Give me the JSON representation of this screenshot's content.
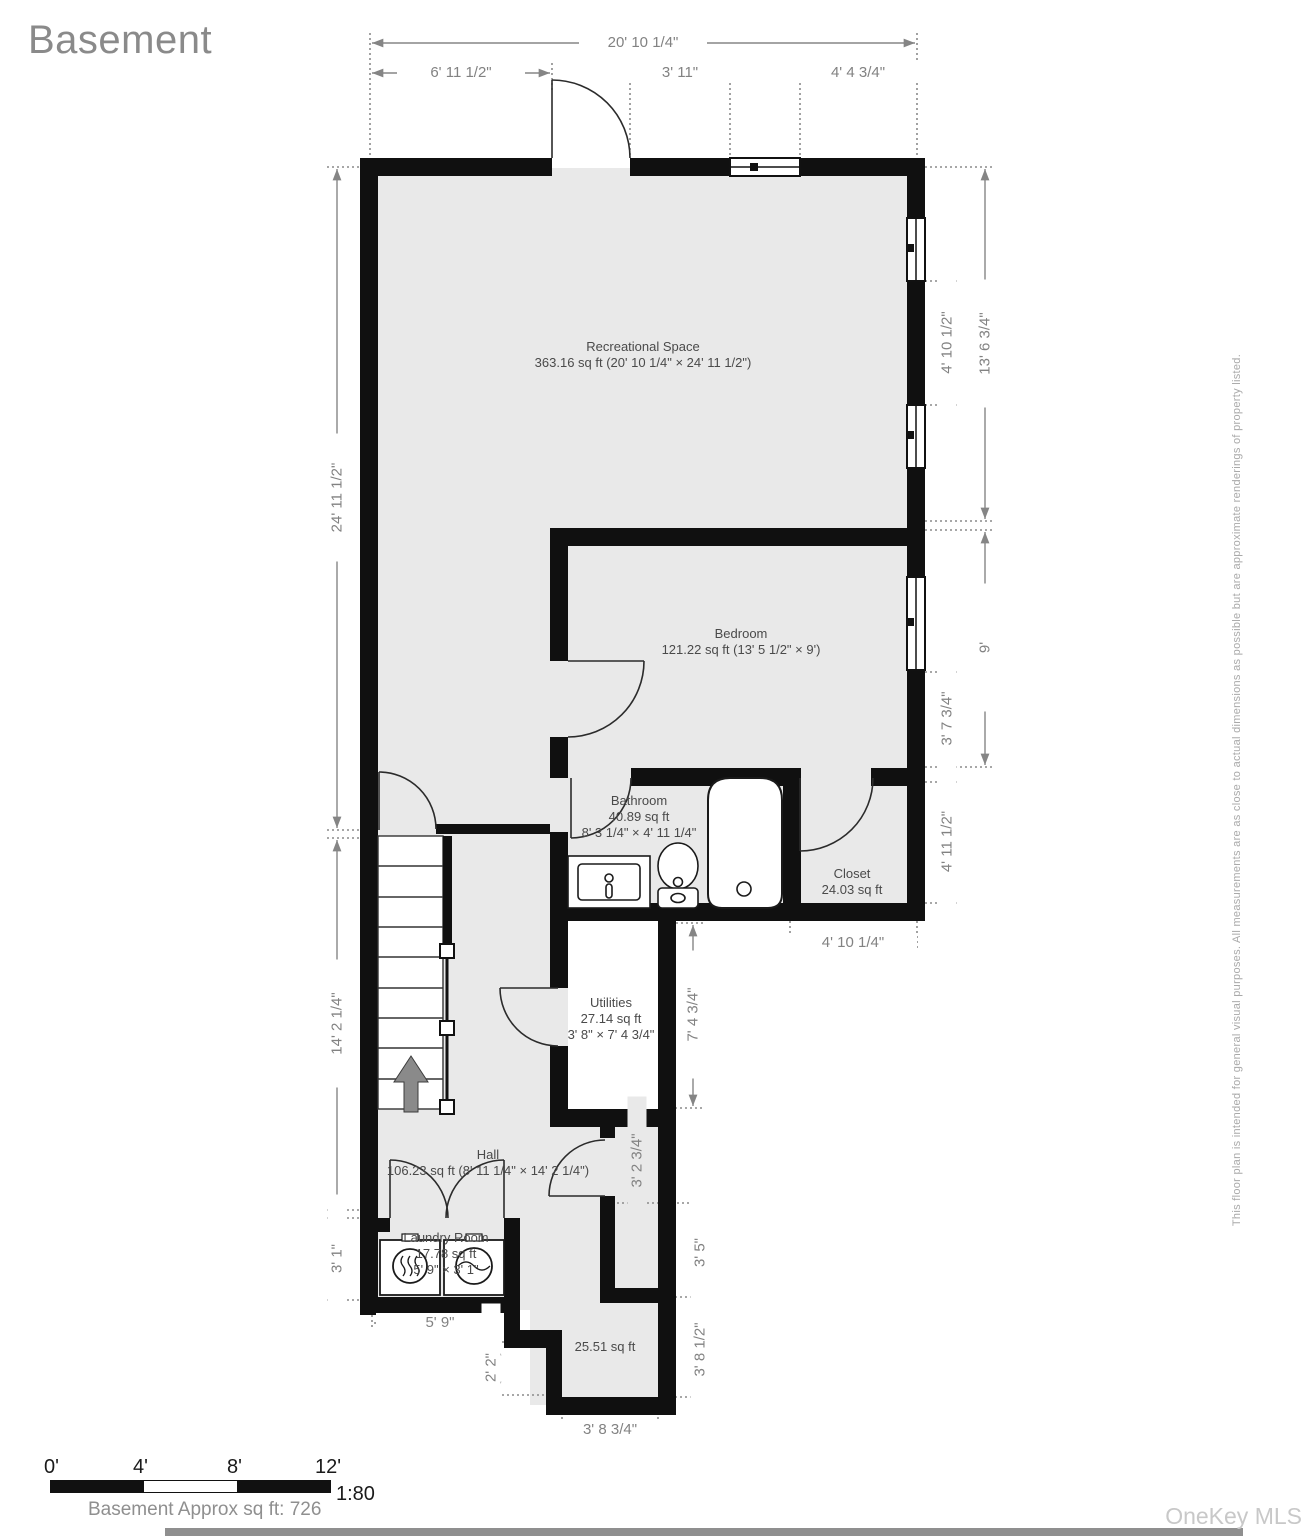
{
  "title": "Basement",
  "rooms": {
    "recreational": {
      "name": "Recreational Space",
      "line2": "363.16 sq ft (20' 10 1/4\" × 24' 11 1/2\")"
    },
    "bedroom": {
      "name": "Bedroom",
      "line2": "121.22 sq ft (13' 5 1/2\" × 9')"
    },
    "bathroom": {
      "name": "Bathroom",
      "line2": "40.89 sq ft",
      "line3": "8' 3 1/4\" × 4' 11 1/4\""
    },
    "closet": {
      "name": "Closet",
      "line2": "24.03 sq ft"
    },
    "utilities": {
      "name": "Utilities",
      "line2": "27.14 sq ft",
      "line3": "3' 8\" × 7' 4 3/4\""
    },
    "hall": {
      "name": "Hall",
      "line2": "106.23 sq ft (8' 11 1/4\" × 14' 2 1/4\")"
    },
    "laundry": {
      "name": "Laundry Room",
      "line2": "17.78 sq ft",
      "line3": "5' 9\" × 3' 1\""
    },
    "nook": {
      "line1": "25.51 sq ft"
    }
  },
  "dimensions": {
    "top_total": "20' 10 1/4\"",
    "top_left": "6' 11 1/2\"",
    "top_mid": "3' 11\"",
    "top_right": "4' 4 3/4\"",
    "left_upper": "24' 11 1/2\"",
    "left_mid": "14' 2 1/4\"",
    "left_lower": "3' 1\"",
    "right_upper_total": "13' 6 3/4\"",
    "right_window_gap": "4' 10 1/2\"",
    "right_bedroom": "9'",
    "right_lower_window": "3' 7 3/4\"",
    "right_closet": "4' 11 1/2\"",
    "closet_width": "4' 10 1/4\"",
    "utilities_height": "7' 4 3/4\"",
    "strip_upper": "3' 2 3/4\"",
    "strip_lower": "3' 5\"",
    "nook_height": "3' 8 1/2\"",
    "nook_width": "3' 8 3/4\"",
    "laundry_width": "5' 9\"",
    "step": "2' 2\""
  },
  "footer": {
    "scale_ticks": [
      "0'",
      "4'",
      "8'",
      "12'"
    ],
    "scale_ratio": "1:80",
    "approx_label": "Basement Approx sq ft: 726",
    "watermark": "OneKey MLS"
  },
  "disclaimer": "This floor plan is intended for general visual purposes. All measurements are as close to actual dimensions as possible but are approximate renderings of property listed.",
  "colors": {
    "wall": "#101010",
    "floor": "#e9e9e9",
    "dimension": "#858585",
    "label": "#4a4a4a"
  }
}
